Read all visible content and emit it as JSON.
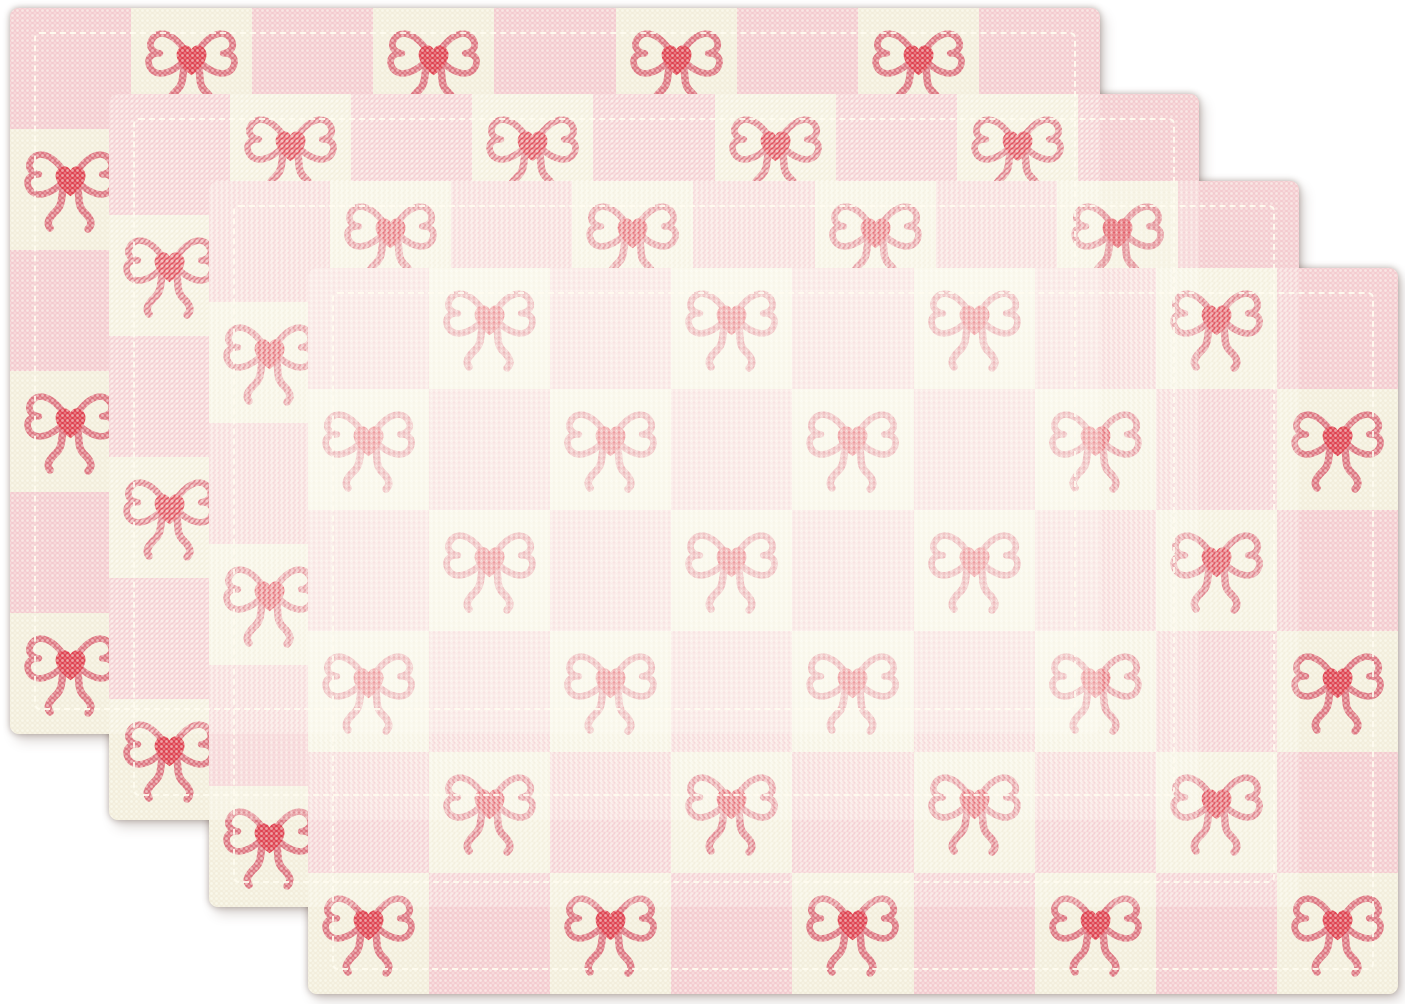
{
  "scene": {
    "description": "Product photo of four pink and cream checkered fabric placemats with red heart-bow pattern, fanned out in a stack on a white background",
    "background_color": "#ffffff",
    "placemat_count": 4
  },
  "placemat": {
    "width_px": 1090,
    "height_px": 726,
    "corner_radius_px": 9,
    "stitch_inset_px": 24,
    "grid": {
      "columns": 9,
      "rows": 6,
      "top_left_square": "pink",
      "bow_on": "cream"
    }
  },
  "placemats": [
    {
      "name": "placemat-1",
      "left_px": 10,
      "top_px": 8
    },
    {
      "name": "placemat-2",
      "left_px": 109,
      "top_px": 94
    },
    {
      "name": "placemat-3",
      "left_px": 209,
      "top_px": 181
    },
    {
      "name": "placemat-4",
      "left_px": 308,
      "top_px": 268
    }
  ],
  "colors": {
    "pink_square": "#f3c8cd",
    "cream_square": "#f2edda",
    "ribbon_rose": "#db6d79",
    "heart_red": "#dc3847",
    "stitch_white": "#fffcf0",
    "shadow": "rgba(96,74,63,0.45)"
  },
  "icons": {
    "bow": "heart-bow-icon"
  }
}
